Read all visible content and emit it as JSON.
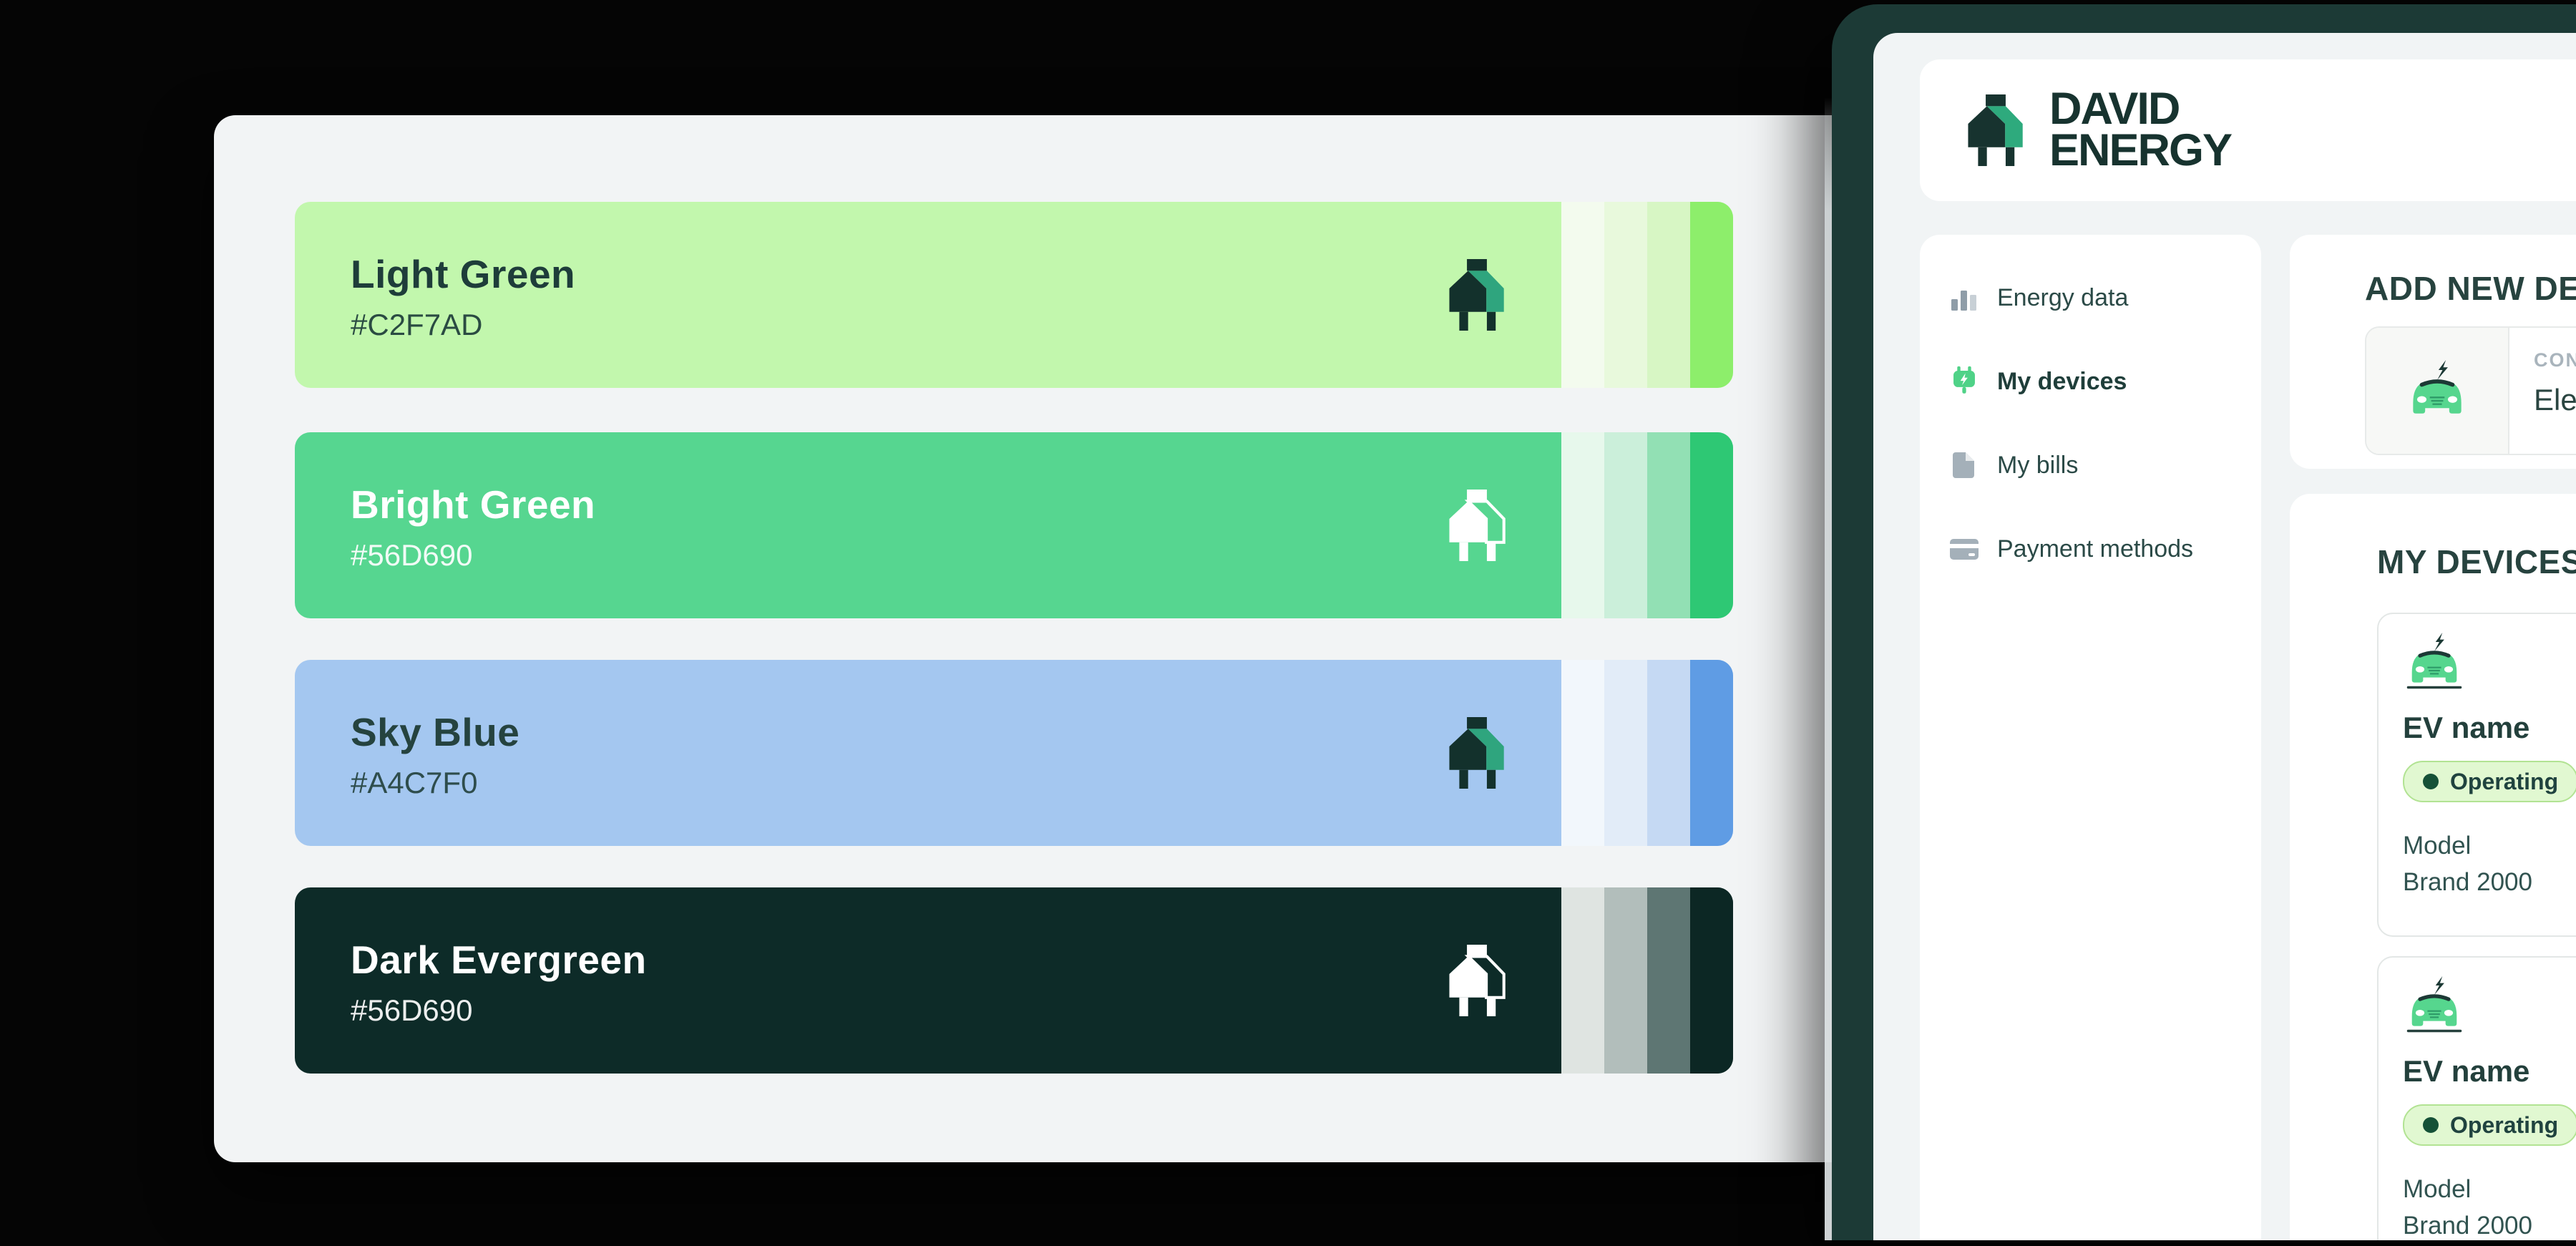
{
  "palette_board": {
    "background": "#F2F4F5",
    "swatches": [
      {
        "name": "Light Green",
        "hex": "#C2F7AD",
        "main": "#C2F7AD",
        "text_color": "#1E3D3A",
        "icon_variant": "dark",
        "strips": [
          "#F3FBEE",
          "#E8F9DC",
          "#D7F6C4",
          "#8DEE6B"
        ]
      },
      {
        "name": "Bright Green",
        "hex": "#56D690",
        "main": "#56D690",
        "text_color": "#FFFFFF",
        "icon_variant": "white",
        "strips": [
          "#E7F8EC",
          "#CBEFDA",
          "#92E0B4",
          "#2EC874"
        ]
      },
      {
        "name": "Sky Blue",
        "hex": "#A4C7F0",
        "main": "#A4C7F0",
        "text_color": "#25433F",
        "icon_variant": "dark",
        "strips": [
          "#F2F7FC",
          "#E2ECF8",
          "#C5D9F3",
          "#5F9CE4"
        ]
      },
      {
        "name": "Dark Evergreen",
        "hex": "#56D690",
        "main": "#0D2B28",
        "text_color": "#FFFFFF",
        "icon_variant": "white",
        "strips": [
          "#DFE4E1",
          "#B2BEBB",
          "#5E7673",
          "#0C2724"
        ]
      }
    ]
  },
  "device": {
    "bezel_color": "#1C3A36",
    "screen_background": "#F1F4F5",
    "logo": {
      "line1": "DAVID",
      "line2": "ENERGY"
    },
    "colors": {
      "brand_dark": "#17332F",
      "logo_green": "#2EAA7D",
      "accent_green": "#56D690",
      "muted_gray": "#A9B4BC",
      "pill_bg": "#E1F8D1",
      "pill_border": "#B2E393",
      "pill_dot": "#155137"
    },
    "sidebar": {
      "items": [
        {
          "label": "Energy data",
          "icon": "bar-chart-icon",
          "active": false
        },
        {
          "label": "My devices",
          "icon": "plug-icon",
          "active": true
        },
        {
          "label": "My bills",
          "icon": "document-icon",
          "active": false
        },
        {
          "label": "Payment methods",
          "icon": "credit-card-icon",
          "active": false
        }
      ]
    },
    "add_device": {
      "heading": "ADD NEW DEVI",
      "option": {
        "kicker": "CON",
        "label": "Elec"
      }
    },
    "my_devices": {
      "heading": "MY DEVICES",
      "devices": [
        {
          "name": "EV name",
          "status": "Operating",
          "model_label": "Model",
          "model_value": "Brand 2000"
        },
        {
          "name": "EV name",
          "status": "Operating",
          "model_label": "Model",
          "model_value": "Brand 2000"
        }
      ]
    }
  }
}
